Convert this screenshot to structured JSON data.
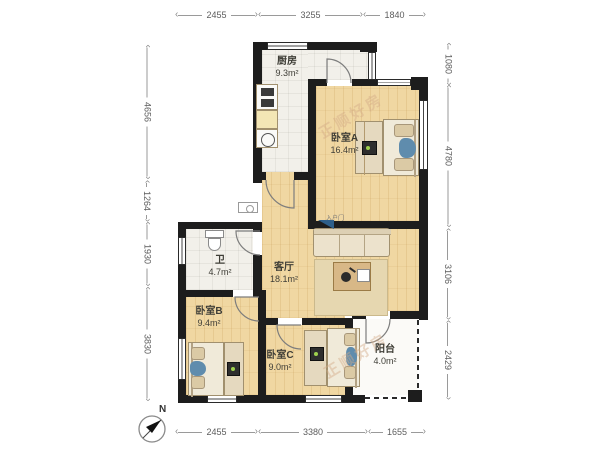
{
  "compass": {
    "label": "N"
  },
  "watermark": {
    "text": "正顺好房"
  },
  "entry": {
    "label": "入户门"
  },
  "rooms": {
    "kitchen": {
      "name": "厨房",
      "area": "9.3m²"
    },
    "bedroomA": {
      "name": "卧室A",
      "area": "16.4m²"
    },
    "bath": {
      "name": "卫",
      "area": "4.7m²"
    },
    "living": {
      "name": "客厅",
      "area": "18.1m²"
    },
    "bedroomB": {
      "name": "卧室B",
      "area": "9.4m²"
    },
    "bedroomC": {
      "name": "卧室C",
      "area": "9.0m²"
    },
    "balcony": {
      "name": "阳台",
      "area": "4.0m²"
    }
  },
  "dimensions": {
    "top": [
      {
        "value": "2455"
      },
      {
        "value": "3255"
      },
      {
        "value": "1840"
      }
    ],
    "bottom": [
      {
        "value": "2455"
      },
      {
        "value": "3380"
      },
      {
        "value": "1655"
      }
    ],
    "left": [
      {
        "value": "4656"
      },
      {
        "value": "1264"
      },
      {
        "value": "1930"
      },
      {
        "value": "3830"
      }
    ],
    "right": [
      {
        "value": "1080"
      },
      {
        "value": "4780"
      },
      {
        "value": "3106"
      },
      {
        "value": "2429"
      }
    ]
  },
  "colors": {
    "wall": "#1d1d1d",
    "wood_floor": "#f0d7a2",
    "tile_floor": "#f2f0ea",
    "accent_blue": "#5f8cad",
    "entry_blue": "#2e5f8a",
    "watermark": "#d2aa87",
    "dim_text": "#5d5d5d"
  }
}
